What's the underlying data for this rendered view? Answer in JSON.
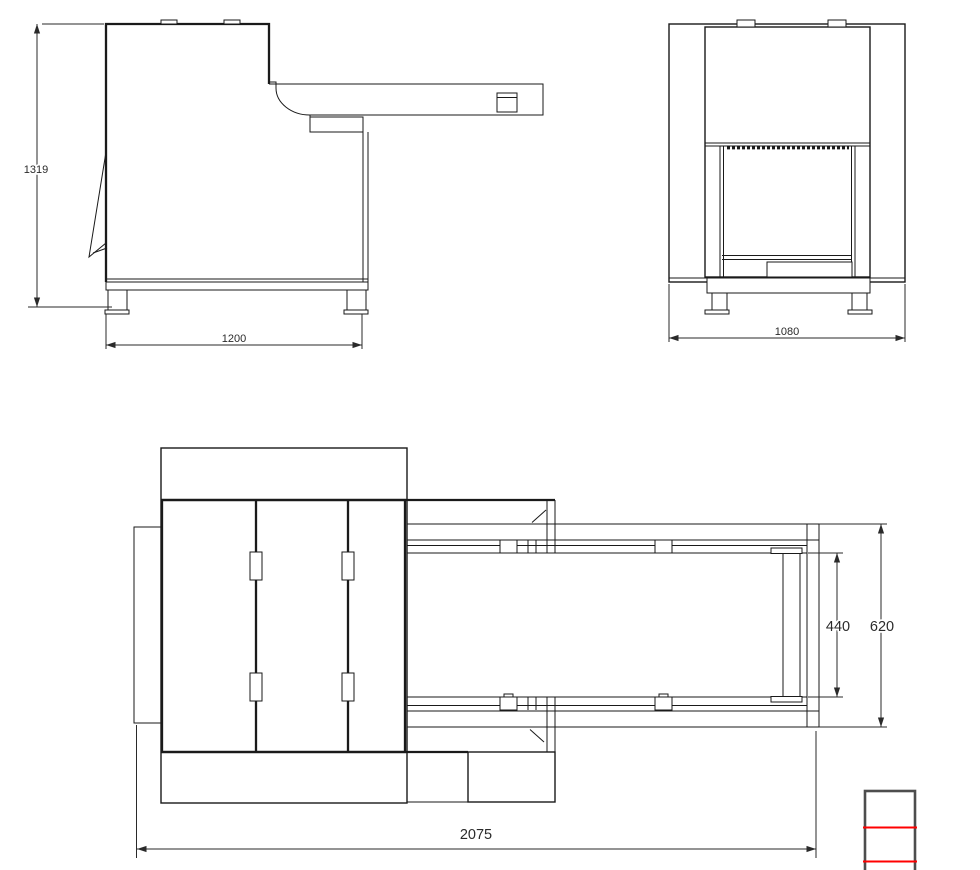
{
  "dims": {
    "side_height": "1319",
    "side_length": "1200",
    "front_width": "1080",
    "belt_width": "440",
    "conveyor_width": "620",
    "overall_length": "2075"
  },
  "colors": {
    "line": "#1a1a1a",
    "dimension": "#2a2a2a",
    "accent_red": "#ff0000",
    "block_border": "#4d4d4d"
  }
}
